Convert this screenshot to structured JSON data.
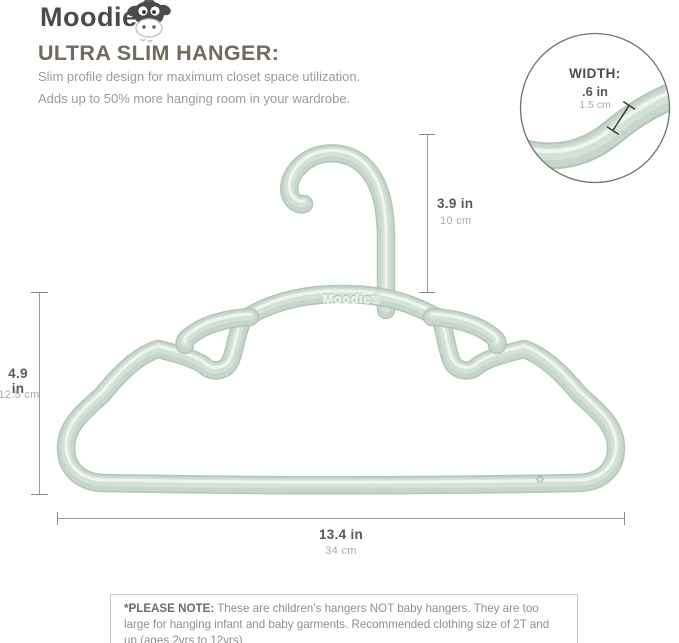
{
  "brand": {
    "name": "Moodie",
    "mascot": "cow-mascot-icon"
  },
  "header": {
    "title": "ULTRA SLIM HANGER:",
    "subtitle_line1": "Slim profile design for maximum closet space utilization.",
    "subtitle_line2": "Adds up to 50% more hanging room in your wardrobe."
  },
  "callout": {
    "label": "WIDTH:",
    "inches": ".6 in",
    "cm": "1.5 cm"
  },
  "dimensions": {
    "hook_height": {
      "inches": "3.9 in",
      "cm": "10 cm"
    },
    "body_height": {
      "inches": "4.9 in",
      "cm": "12.5 cm"
    },
    "width": {
      "inches": "13.4 in",
      "cm": "34 cm"
    }
  },
  "hanger": {
    "embossed_text": "Moodie®",
    "recycle_glyph": "♻"
  },
  "note": {
    "label": "*PLEASE NOTE:",
    "body": "These are children’s hangers NOT baby hangers.  They are too large for hanging infant and baby garments.  Recommended clothing size of 2T and up (ages 2yrs to 12yrs)."
  },
  "colors": {
    "hanger_base": "#c6d5ca",
    "hanger_edge": "#b2c6b8",
    "hanger_gloss": "#eef5ef",
    "title": "#716a5d",
    "logo": "#4b4b4d",
    "body_text": "#9b9b9b",
    "dim_dark": "#57585a",
    "dim_light": "#a9abad",
    "line_gray": "#9b9b9b"
  }
}
